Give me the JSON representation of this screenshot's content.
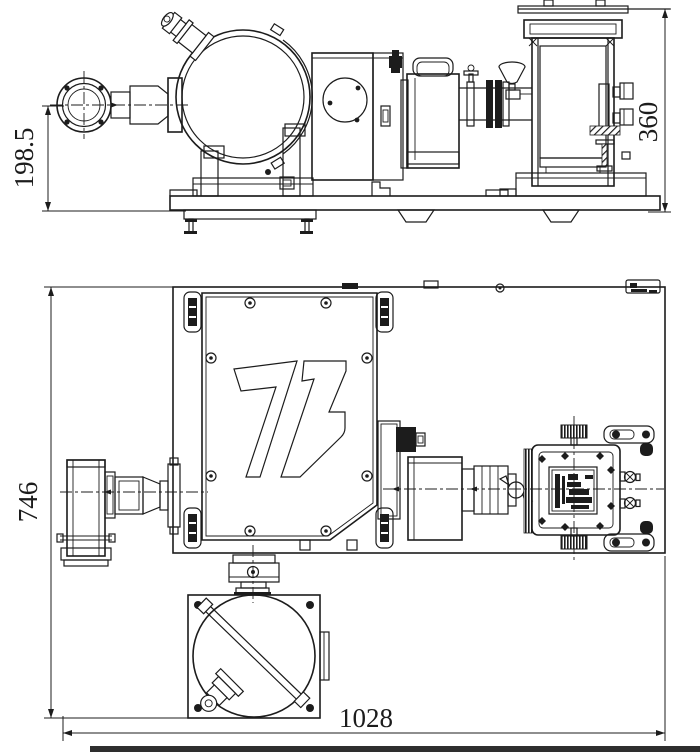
{
  "canvas": {
    "background": "#ffffff",
    "line_color": "#1c1c1c",
    "bottom_strip_color": "#2e2e2e"
  },
  "side_view": {
    "name": "side elevation view of instrument assembly",
    "dim_height_left": "198.5",
    "dim_height_right": "360"
  },
  "plan_view": {
    "name": "top plan view of instrument assembly",
    "dim_depth_left": "746",
    "dim_width_bottom": "1028"
  }
}
